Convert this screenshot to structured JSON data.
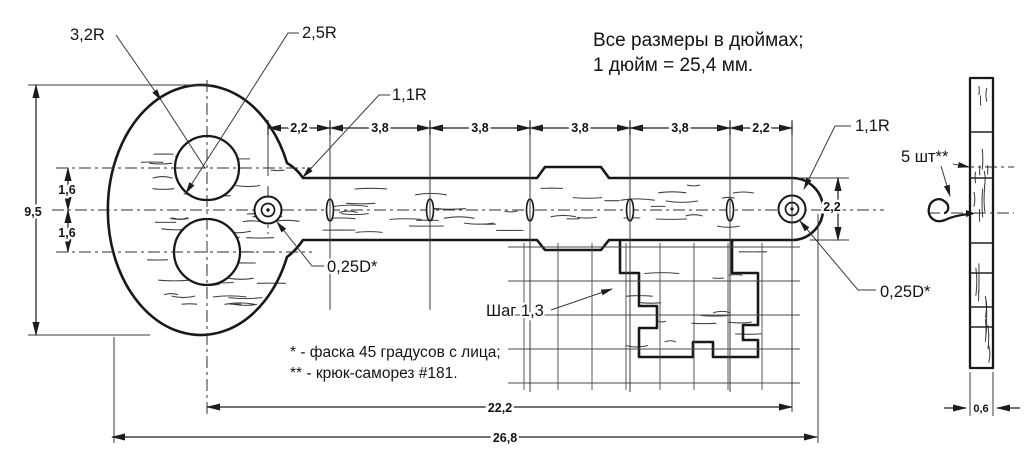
{
  "note": {
    "line1": "Все размеры в дюймах;",
    "line2": "1 дюйм = 25,4 мм."
  },
  "labels": {
    "head_radius": "3,2R",
    "bow_hole_radius": "2,5R",
    "neck_fillet_radius": "1,1R",
    "end_fillet_radius": "1,1R",
    "screw_hole_left": "0,25D*",
    "screw_hole_right": "0,25D*",
    "grid_step": "Шаг 1,3",
    "hooks_count": "5 шт**"
  },
  "dimensions": {
    "top_chain": [
      "2,2",
      "3,8",
      "3,8",
      "3,8",
      "3,8",
      "2,2"
    ],
    "head_height": "9,5",
    "upper_hole_offset": "1,6",
    "lower_hole_offset": "1,6",
    "shank_height": "2,2",
    "holes_span": "22,2",
    "total_length": "26,8",
    "board_thickness": "0,6"
  },
  "footnotes": {
    "chamfer": "* - фаска 45 градусов с лица;",
    "hook": "** - крюк-саморез #181."
  },
  "colors": {
    "line": "#181818",
    "background": "#ffffff"
  }
}
